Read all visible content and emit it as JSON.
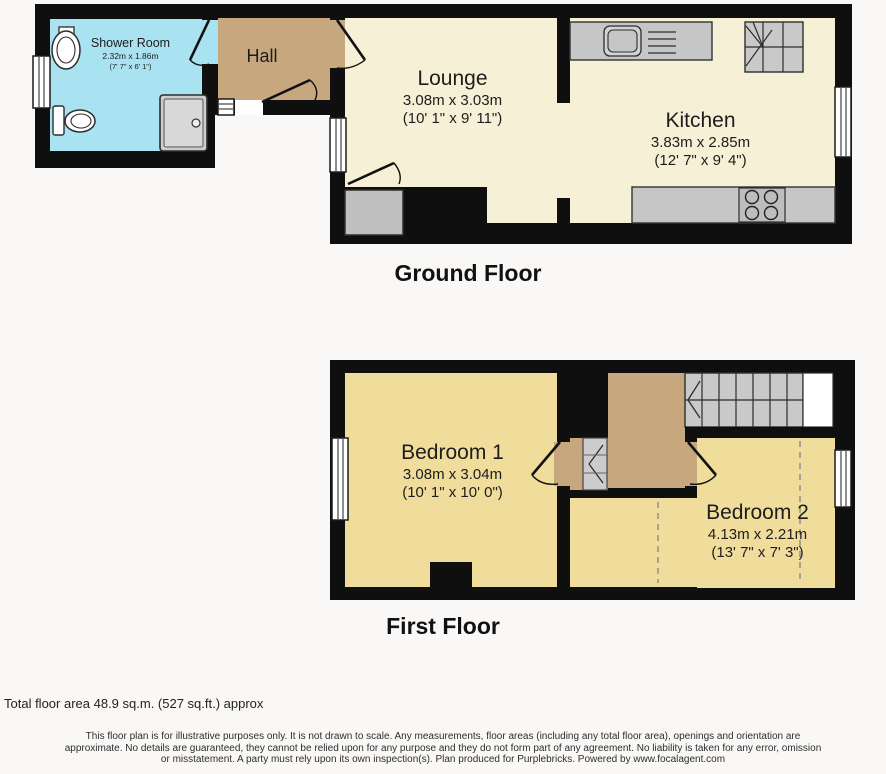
{
  "colors": {
    "wall": "#0f0f0f",
    "shower_room_fill": "#a9e2f1",
    "hall_landing_fill": "#c6a77e",
    "living_kitchen_fill": "#f6f0d6",
    "bedroom_fill": "#f0dc9b",
    "fixture_gray": "#c6c6c6",
    "stairs_gray": "#c9c9c9",
    "page_background": "#f9f8f6"
  },
  "floors": {
    "ground": {
      "label": "Ground Floor"
    },
    "first": {
      "label": "First Floor"
    }
  },
  "rooms": {
    "shower_room": {
      "name": "Shower Room",
      "dims_metric": "2.32m x 1.86m",
      "dims_imperial": "(7' 7\" x 6' 1\")"
    },
    "hall": {
      "name": "Hall"
    },
    "lounge": {
      "name": "Lounge",
      "dims_metric": "3.08m x 3.03m",
      "dims_imperial": "(10' 1\" x 9' 11\")"
    },
    "kitchen": {
      "name": "Kitchen",
      "dims_metric": "3.83m x 2.85m",
      "dims_imperial": "(12' 7\" x 9' 4\")"
    },
    "bedroom_1": {
      "name": "Bedroom 1",
      "dims_metric": "3.08m x 3.04m",
      "dims_imperial": "(10' 1\" x 10' 0\")"
    },
    "bedroom_2": {
      "name": "Bedroom 2",
      "dims_metric": "4.13m x 2.21m",
      "dims_imperial": "(13' 7\" x 7' 3\")"
    }
  },
  "footer": {
    "total_area": "Total floor area 48.9 sq.m. (527 sq.ft.) approx",
    "disclaimer_lines": [
      "This floor plan is for illustrative purposes only. It is not drawn to scale. Any measurements, floor areas (including any total floor area), openings and orientation are",
      "approximate. No details are guaranteed, they cannot be relied upon for any purpose and they do not form part of any agreement. No liability is taken for any error, omission",
      "or misstatement. A party must rely upon its own inspection(s). Plan produced for Purplebricks. Powered by www.focalagent.com"
    ]
  }
}
